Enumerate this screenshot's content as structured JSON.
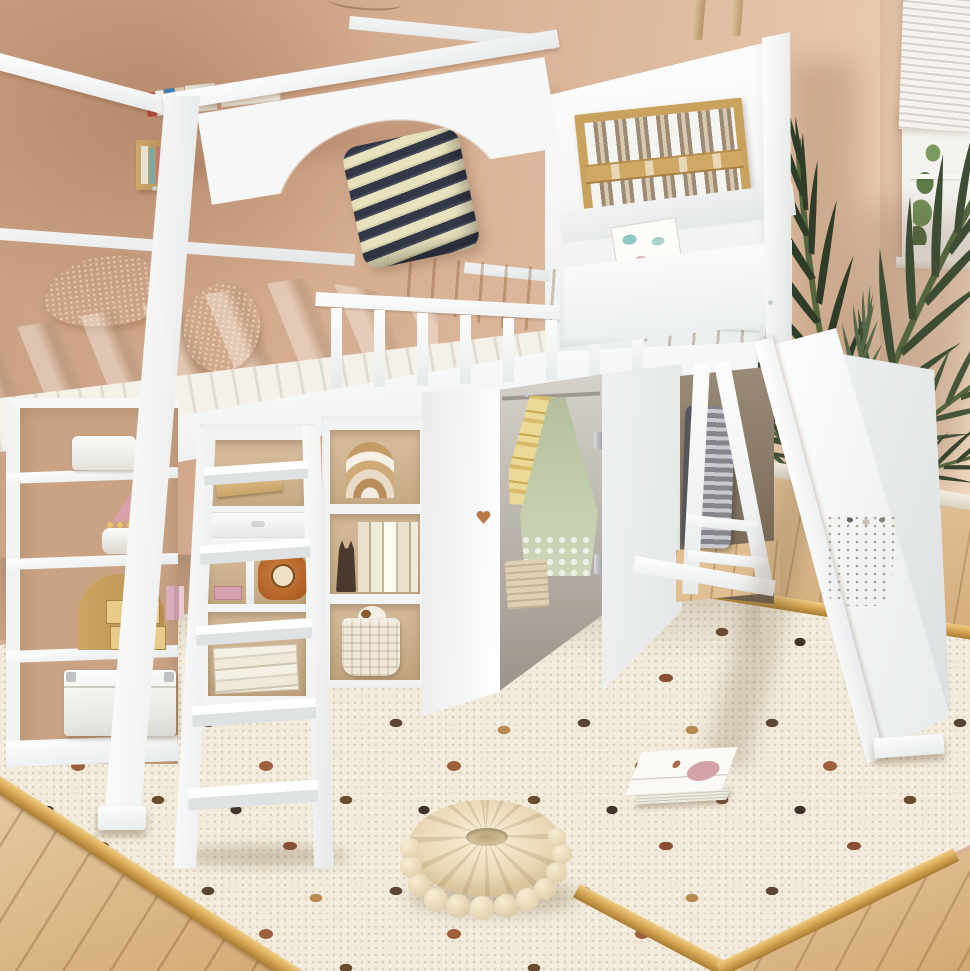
{
  "scene": {
    "type": "product-photograph",
    "subject": "white twin loft bed with slide, ladder, open shelves and wardrobe staged in a kids bedroom",
    "room": {
      "wall_color": "#d9b196",
      "floor": "light oak plank floor",
      "rug": "cream boucle rug with multicolor polka dots and wood trim edge",
      "window": "white framed window with white venetian blinds, greenery outside",
      "wall_decor": [
        "two hanging wood sticks",
        "thin ceiling wire"
      ]
    },
    "furniture": {
      "bed_color": "#f6f7f7",
      "parts": [
        "canopy frame",
        "arched side rail",
        "spindle guardrail",
        "lattice window panel",
        "hanging storage pocket",
        "left shelf tower",
        "mid shelf unit",
        "bookshelf",
        "wardrobe with heart cutout door",
        "ladder with five rungs",
        "white slide",
        "A-frame slide support"
      ]
    },
    "bedding": {
      "striped_pillow": {
        "navy": "#2e3440",
        "cream": "#eae3c0"
      },
      "gold_pillows": 2,
      "gold_pillow_color": "#e0a84e",
      "blanket_orange": "#dd9440",
      "duvet_beige": "#d7c9b4",
      "sheet_white": "#f4f1e9"
    },
    "props": [
      {
        "name": "books-on-canopy-beam",
        "colors": [
          "#b8433a",
          "#3f7fb5",
          "#d9c9a8",
          "#f0efe8"
        ]
      },
      {
        "name": "post-wall-shelf",
        "color": "#c9a368"
      },
      {
        "name": "picture-book-in-pocket",
        "accent": "#8fc9c0"
      },
      {
        "name": "white-basket",
        "color": "#f6f6f4"
      },
      {
        "name": "crown-trinket",
        "color": "#d9a0a8"
      },
      {
        "name": "wooden-mini-drawers",
        "color": "#d9b272"
      },
      {
        "name": "pink-books",
        "color": "#d9aebc"
      },
      {
        "name": "storage-trunk",
        "color": "#f4f4f2"
      },
      {
        "name": "tablet",
        "color": "#d9b583"
      },
      {
        "name": "elephant-clock",
        "color": "#c07030"
      },
      {
        "name": "magazine-stack",
        "color": "#efe9da"
      },
      {
        "name": "rainbow-arch-toy",
        "colors": [
          "#e8dcc8",
          "#cfa978",
          "#b98d5c"
        ]
      },
      {
        "name": "book-row-with-cat-bookend",
        "bookend": "#4a3a2e"
      },
      {
        "name": "woven-basket-with-plush",
        "color": "#efe8da"
      },
      {
        "name": "yellow-striped-garment",
        "color": "#ecd998"
      },
      {
        "name": "sage-lace-dress",
        "color": "#b9c4a3"
      },
      {
        "name": "hamper-in-wardrobe",
        "color": "#ded0b4"
      },
      {
        "name": "ribbed-suitcase",
        "colors": [
          "#c9c9cf",
          "#8a8a92"
        ]
      },
      {
        "name": "potted-palm",
        "leaf": "#3d4d33",
        "pot": "#e6e3da"
      },
      {
        "name": "round-pouf",
        "color": "#efe6ce",
        "pompoms": 12
      },
      {
        "name": "magazine-on-rug",
        "accent": "#d4a3aa"
      }
    ],
    "rug_dots": {
      "colors": [
        "#5a4535",
        "#9c603c",
        "#b98a50",
        "#3f332a",
        "#8a4f33",
        "#6b4a30"
      ]
    },
    "counts": {
      "guardrail_spindles": 8,
      "ladder_rungs": 5,
      "lattice_slats": 8
    }
  }
}
